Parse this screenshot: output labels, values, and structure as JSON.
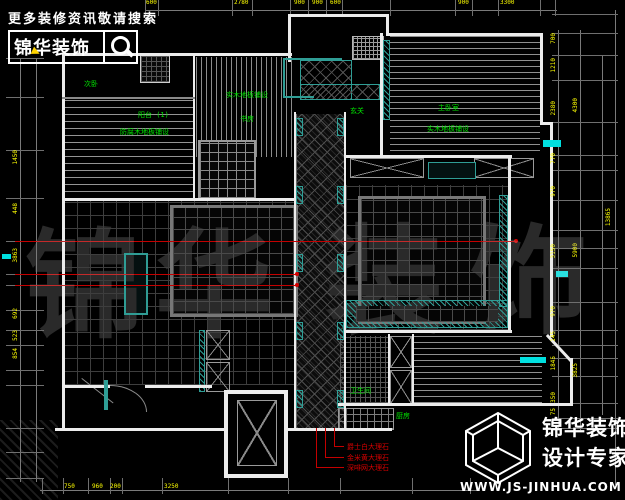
{
  "branding": {
    "slogan": "更多装修资讯敬请搜索",
    "brand": "锦华装饰",
    "footer_brand": "锦华装饰",
    "footer_tagline": "设计专家",
    "website": "WWW.JS-JINHUA.COM",
    "watermark": [
      "锦",
      "华",
      "装",
      "饰"
    ]
  },
  "labels": {
    "bedroom2": "次卧",
    "balcony1_name": "阳台 (1)",
    "balcony1_finish": "防腐木地板铺设",
    "study_finish": "实木地板铺设",
    "study_name": "书房",
    "master_name": "主卧室",
    "master_finish": "实木地板铺设",
    "foyer": "玄关",
    "bathroom": "卫生间",
    "kitchen": "厨房"
  },
  "callouts": {
    "marble1": "爵士白大理石",
    "marble2": "金米黄大理石",
    "marble3": "深啡网大理石"
  },
  "dimensions": {
    "top": [
      "600",
      "2780",
      "900",
      "900",
      "600",
      "900",
      "3300"
    ],
    "bottom": [
      "750",
      "960",
      "200",
      "3250"
    ],
    "left": [
      "1450",
      "448",
      "3863",
      "692",
      "523",
      "854"
    ],
    "right_inner": [
      "700",
      "1210",
      "2380",
      "770",
      "970",
      "3150",
      "970",
      "145",
      "1845",
      "350",
      "75"
    ],
    "right_outer": [
      "4300",
      "5900",
      "3825"
    ],
    "right_total": "13865"
  },
  "colors": {
    "background": "#000000",
    "wall": "#ececec",
    "teal": "#2f9d95",
    "highlight_cyan": "#00e0e0",
    "label_green": "#00e600",
    "dim_yellow": "#ffff00",
    "leader_red": "#c40000",
    "watermark_gray": "#2a2a2a"
  }
}
